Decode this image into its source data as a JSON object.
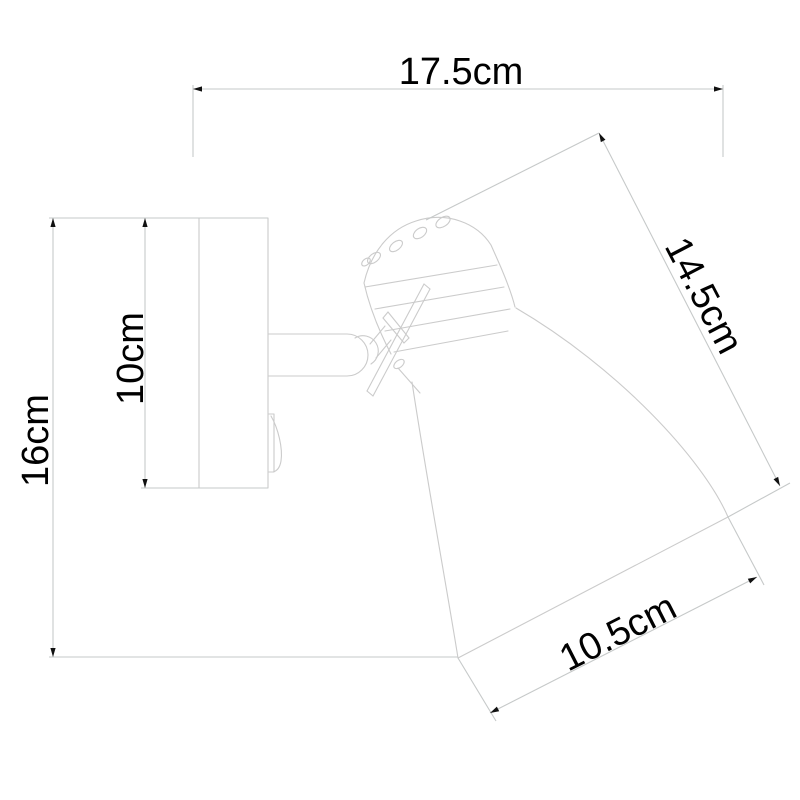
{
  "diagram": {
    "type": "technical-dimension-drawing",
    "subject": "wall-mounted adjustable spotlight lamp, side view line drawing",
    "background_color": "#ffffff",
    "artwork_line_color": "#cbcbcb",
    "dimension_line_color": "#c6c9c9",
    "text_color": "#000000",
    "labels": {
      "overall_width": "17.5cm",
      "overall_height": "16cm",
      "backplate_height": "10cm",
      "head_length": "14.5cm",
      "shade_diameter": "10.5cm"
    }
  }
}
